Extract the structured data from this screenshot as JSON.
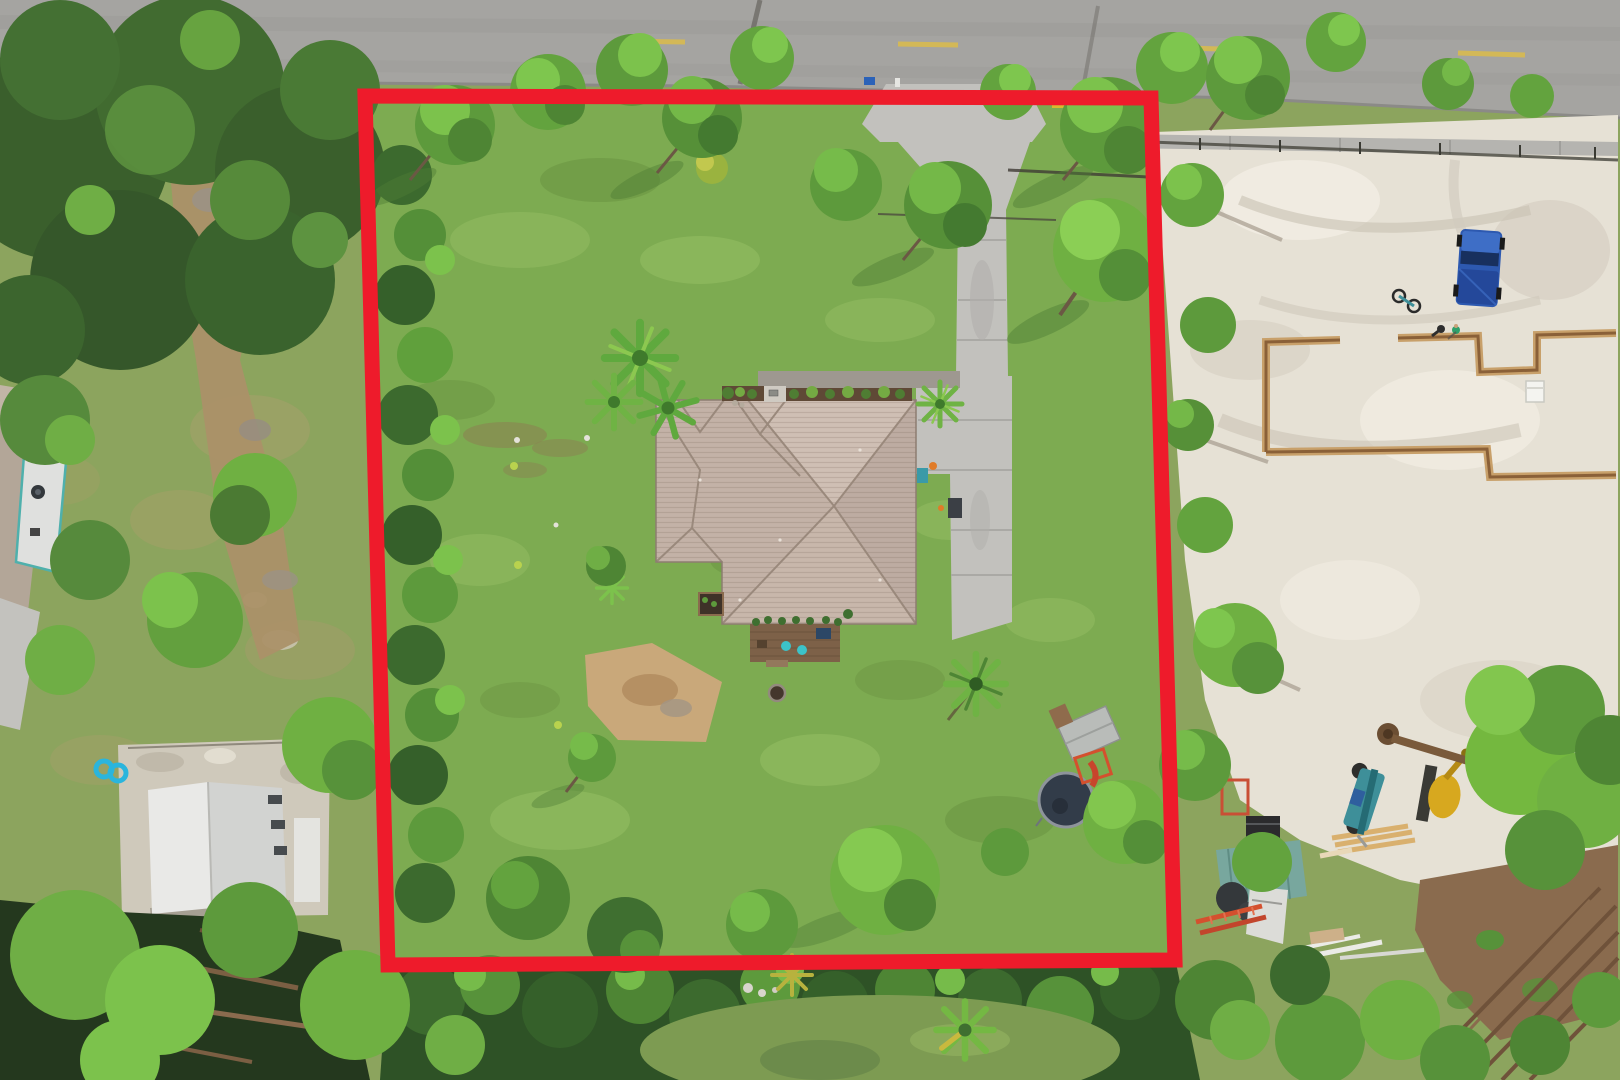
{
  "meta": {
    "title": "Aerial drone photo of a residential property with its lot boundary outlined in red",
    "type": "drone-photo",
    "width": 1620,
    "height": 1080
  },
  "boundary": {
    "label": "lot-boundary-outline",
    "color": "#ee1b2b",
    "stroke_width": 15,
    "points": "365,96 1151,98 1175,960 388,965",
    "corners": {
      "top_left": [
        365,
        96
      ],
      "top_right": [
        1151,
        98
      ],
      "bottom_right": [
        1175,
        960
      ],
      "bottom_left": [
        388,
        965
      ]
    }
  },
  "palette": {
    "grass_outside": "#8ca45e",
    "lawn": "#7dab51",
    "lawn_light": "#9cc468",
    "lawn_dark": "#689140",
    "road": "#a5a4a1",
    "road_line": "#d9bb50",
    "sidewalk": "#b5b4b0",
    "concrete": "#c2c1bd",
    "sand": "#e6e1d5",
    "soil": "#8a6b4e",
    "dirt_path": "#ab9168",
    "roof": "#c4b3a9",
    "roof_light": "#cfbfb4",
    "roof_dark": "#bdaca2",
    "deck": "#7d6148",
    "tree_bright": "#7cc24c",
    "tree_mid": "#5d9a3c",
    "tree_dark": "#35602a",
    "trench": "#a9845c",
    "truck_blue": "#2d59b0",
    "trampoline": "#323c49",
    "container_teal": "#78a79e",
    "machine_teal": "#3e8f99",
    "machine_yellow": "#d7a81f",
    "ladder_orange": "#d4502e",
    "float_blue": "#2ab5dd",
    "boundary_red": "#ee1b2b"
  },
  "objects": [
    {
      "name": "paved-road",
      "description": "Asphalt road with dashed yellow centerline along the top edge"
    },
    {
      "name": "sidewalk",
      "description": "Concrete sidewalk strip between the road and the lots"
    },
    {
      "name": "lot-boundary-outline",
      "description": "Red quadrilateral overlay marking the property boundary"
    },
    {
      "name": "house-roof",
      "description": "Hip-roofed single-family home with gray-tan shingles at the lot center"
    },
    {
      "name": "driveway",
      "description": "Concrete driveway running from the road to the right side of the house"
    },
    {
      "name": "front-walkway-garden",
      "description": "Paver walk and mulched shrub beds along the front of the house"
    },
    {
      "name": "rear-deck",
      "description": "Small wood deck with teal patio chairs behind the house"
    },
    {
      "name": "fire-pit",
      "description": "Small fire-pit ring in the backyard lawn"
    },
    {
      "name": "trampoline",
      "description": "Round dark trampoline near the east boundary"
    },
    {
      "name": "playhouse",
      "description": "Metal-roofed playhouse with orange slide beside the trampoline"
    },
    {
      "name": "backyard-palm",
      "description": "Palm tree in the backyard lawn"
    },
    {
      "name": "front-palm-cluster",
      "description": "Cluster of palms northwest of the house"
    },
    {
      "name": "bare-sand-patch",
      "description": "Worn sandy patch in the backyard lawn"
    },
    {
      "name": "boundary-hedge",
      "description": "Dense hedge and tree line along the west boundary"
    },
    {
      "name": "dirt-path",
      "description": "Dirt track on the neighboring lot to the west"
    },
    {
      "name": "neighbor-house",
      "description": "Neighboring house roof at the far left edge"
    },
    {
      "name": "neighbor-shed",
      "description": "White gabled shed on a gravel pad at lower left"
    },
    {
      "name": "pool-float",
      "description": "Blue figure-8 pool float on the grass near the shed"
    },
    {
      "name": "construction-site",
      "description": "Cleared sandy lot to the east with foundation work underway"
    },
    {
      "name": "foundation-trenches",
      "description": "Footing trenches outlining the new home's floor plan"
    },
    {
      "name": "pickup-truck",
      "description": "Blue pickup truck parked on the sand"
    },
    {
      "name": "workers",
      "description": "Two workers standing near the trenches"
    },
    {
      "name": "bicycle",
      "description": "Bicycle lying on the sand"
    },
    {
      "name": "porta-potty",
      "description": "White portable toilet beside the trenches"
    },
    {
      "name": "telehandler",
      "description": "Teal lift machine parked by the lumber"
    },
    {
      "name": "excavator",
      "description": "Yellow machine under a tree"
    },
    {
      "name": "storage-container",
      "description": "Teal jobsite storage container"
    },
    {
      "name": "ladders",
      "description": "Orange extension ladders on the ground"
    },
    {
      "name": "lumber-pile",
      "description": "Stacked framing lumber"
    },
    {
      "name": "fallen-tree",
      "description": "Uprooted pine lying on the sand, crown toward the east"
    },
    {
      "name": "irrigation-pipes",
      "description": "Long pipes laid diagonally over disturbed soil in the southeast corner"
    }
  ]
}
